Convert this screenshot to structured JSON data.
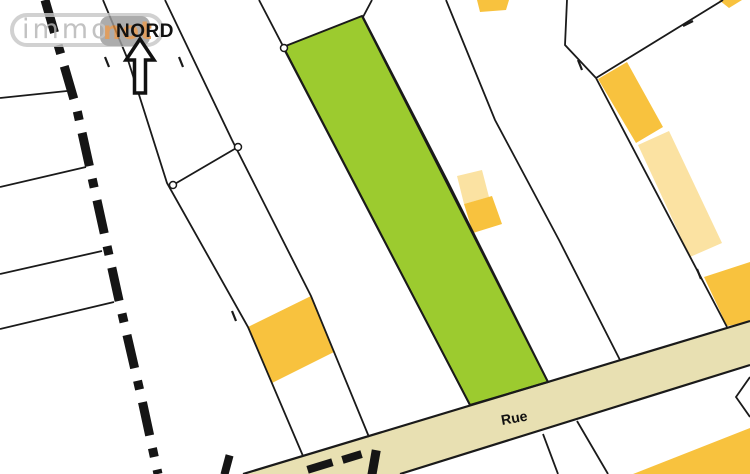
{
  "map": {
    "north_label": "NORD",
    "street_label": "Rue",
    "logo": {
      "text": "immo",
      "accent_text": "not"
    },
    "colors": {
      "highlight_parcel_green": "#9CCB2F",
      "building_orange": "#F8C23E",
      "building_light_yellow": "#FBE2A2",
      "road_beige": "#E8E0B2",
      "line_black": "#1A1A1A",
      "boundary_black": "#151515",
      "logo_outline_gray": "#C8C8C8",
      "logo_text_gray": "#B5B5B5",
      "logo_box_gray": "#9B9B9B",
      "logo_accent_orange": "#D9893E",
      "label_black": "#111111"
    }
  }
}
